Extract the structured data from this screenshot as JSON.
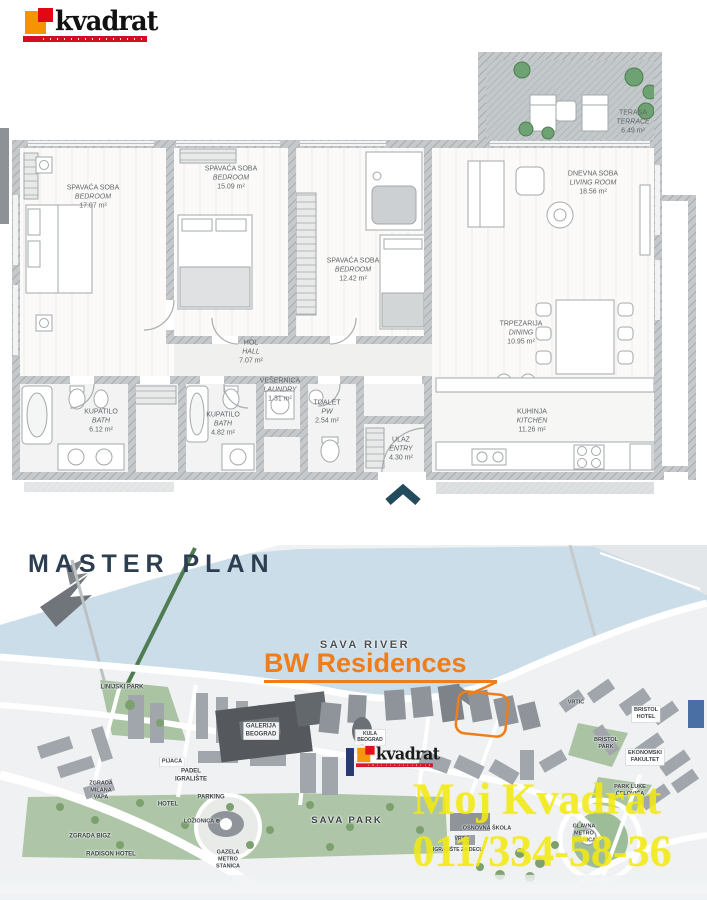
{
  "logo": {
    "text": "kvadrat",
    "orange": "#f59300",
    "red": "#e30613"
  },
  "floor_plan": {
    "entry_arrow": "chevron-up",
    "rooms": [
      {
        "id": "bedroom-1",
        "name_sr": "SPAVAĆA SOBA",
        "name_en": "BEDROOM",
        "area": "17.07 m²",
        "x": 93,
        "y": 197
      },
      {
        "id": "bedroom-2",
        "name_sr": "SPAVAĆA SOBA",
        "name_en": "BEDROOM",
        "area": "15.09 m²",
        "x": 231,
        "y": 178
      },
      {
        "id": "bedroom-3",
        "name_sr": "SPAVAĆA SOBA",
        "name_en": "BEDROOM",
        "area": "12.42 m²",
        "x": 353,
        "y": 270
      },
      {
        "id": "living-room",
        "name_sr": "DNEVNA SOBA",
        "name_en": "LIVING ROOM",
        "area": "18.56 m²",
        "x": 593,
        "y": 183
      },
      {
        "id": "dining",
        "name_sr": "TRPEZARIJA",
        "name_en": "DINING",
        "area": "10.95 m²",
        "x": 521,
        "y": 333
      },
      {
        "id": "hall",
        "name_sr": "HOL",
        "name_en": "HALL",
        "area": "7.07 m²",
        "x": 251,
        "y": 352
      },
      {
        "id": "laundry",
        "name_sr": "VEŠERNICA",
        "name_en": "LAUNDRY",
        "area": "1.31 m²",
        "x": 280,
        "y": 390
      },
      {
        "id": "bath-1",
        "name_sr": "KUPATILO",
        "name_en": "BATH",
        "area": "6.12 m²",
        "x": 101,
        "y": 421
      },
      {
        "id": "bath-2",
        "name_sr": "KUPATILO",
        "name_en": "BATH",
        "area": "4.82 m²",
        "x": 223,
        "y": 424
      },
      {
        "id": "toilet",
        "name_sr": "TOALET",
        "name_en": "PW",
        "area": "2.54 m²",
        "x": 327,
        "y": 412
      },
      {
        "id": "kitchen",
        "name_sr": "KUHINJA",
        "name_en": "KITCHEN",
        "area": "11.26 m²",
        "x": 532,
        "y": 421
      },
      {
        "id": "entry",
        "name_sr": "ULAZ",
        "name_en": "ENTRY",
        "area": "4.30 m²",
        "x": 401,
        "y": 449
      },
      {
        "id": "terrace",
        "name_sr": "TERASA",
        "name_en": "TERRACE",
        "area": "6.49 m²",
        "x": 633,
        "y": 122
      }
    ]
  },
  "map": {
    "title": "MASTER PLAN",
    "highlight": {
      "label": "BW Residences",
      "color": "#ee7d1a"
    },
    "watermark": {
      "line1": "Moj Kvadrat",
      "line2": "011/334-58-36"
    },
    "labels": [
      {
        "id": "sava-river",
        "text": "SAVA RIVER",
        "x": 365,
        "y": 646,
        "size": 11,
        "spacing": 2.5,
        "color": "#4a5056"
      },
      {
        "id": "linijski-park",
        "text": "LINIJSKI PARK",
        "x": 122,
        "y": 688
      },
      {
        "id": "galerija-beograd",
        "text": "GALERIJA\nBEOGRAD",
        "x": 261,
        "y": 731,
        "box": true
      },
      {
        "id": "kula-beograd",
        "text": "KULA\nBEOGRAD",
        "x": 370,
        "y": 737,
        "size": 5,
        "box": true
      },
      {
        "id": "pijaca",
        "text": "PIJACA",
        "x": 172,
        "y": 762,
        "size": 5.5,
        "box": true
      },
      {
        "id": "padel-igraliste",
        "text": "PADEL\nIGRALIŠTE",
        "x": 191,
        "y": 776
      },
      {
        "id": "zgrada-milana-vapa",
        "text": "ZGRADA\nMILANA\nVAPA",
        "x": 101,
        "y": 791,
        "size": 5.5
      },
      {
        "id": "hotel",
        "text": "HOTEL",
        "x": 168,
        "y": 805
      },
      {
        "id": "parking",
        "text": "PARKING",
        "x": 211,
        "y": 798
      },
      {
        "id": "lozionica",
        "text": "LOŽIONICA ⊕",
        "x": 202,
        "y": 822,
        "size": 5.5
      },
      {
        "id": "zgrada-bigz",
        "text": "ZGRADA BIGZ",
        "x": 90,
        "y": 837
      },
      {
        "id": "radison-hotel",
        "text": "RADISON HOTEL",
        "x": 111,
        "y": 855
      },
      {
        "id": "gazela-metro",
        "text": "GAZELA\nMETRO\nSTANICA",
        "x": 228,
        "y": 860,
        "size": 5.5
      },
      {
        "id": "sava-park",
        "text": "SAVA  PARK",
        "x": 347,
        "y": 821,
        "size": 9.5,
        "spacing": 2
      },
      {
        "id": "osnovna-skola",
        "text": "OSNOVNA ŠKOLA",
        "x": 487,
        "y": 829,
        "size": 5.5
      },
      {
        "id": "vrtic-skola",
        "text": "VRTIĆ",
        "x": 462,
        "y": 839,
        "size": 5
      },
      {
        "id": "igraliste-za-decu",
        "text": "IGRALIŠTE ZA DECU",
        "x": 458,
        "y": 850,
        "size": 5
      },
      {
        "id": "glavna-metro",
        "text": "GLAVNA\nMETRO\nSTANICA",
        "x": 584,
        "y": 834,
        "size": 5.5
      },
      {
        "id": "park-luke-celovica",
        "text": "PARK LUKE\nĆELOVIĆA",
        "x": 630,
        "y": 791,
        "size": 5.5
      },
      {
        "id": "ekonomski-fakultet",
        "text": "EKONOMSKI\nFAKULTET",
        "x": 645,
        "y": 757,
        "size": 5.5,
        "box": true
      },
      {
        "id": "bristol-park",
        "text": "BRISTOL\nPARK",
        "x": 606,
        "y": 744,
        "size": 5.5
      },
      {
        "id": "bristol-hotel",
        "text": "BRISTOL\nHOTEL",
        "x": 646,
        "y": 714,
        "size": 5.5,
        "box": true
      },
      {
        "id": "vrtic",
        "text": "VRTIĆ",
        "x": 576,
        "y": 703,
        "size": 5.5
      }
    ]
  }
}
